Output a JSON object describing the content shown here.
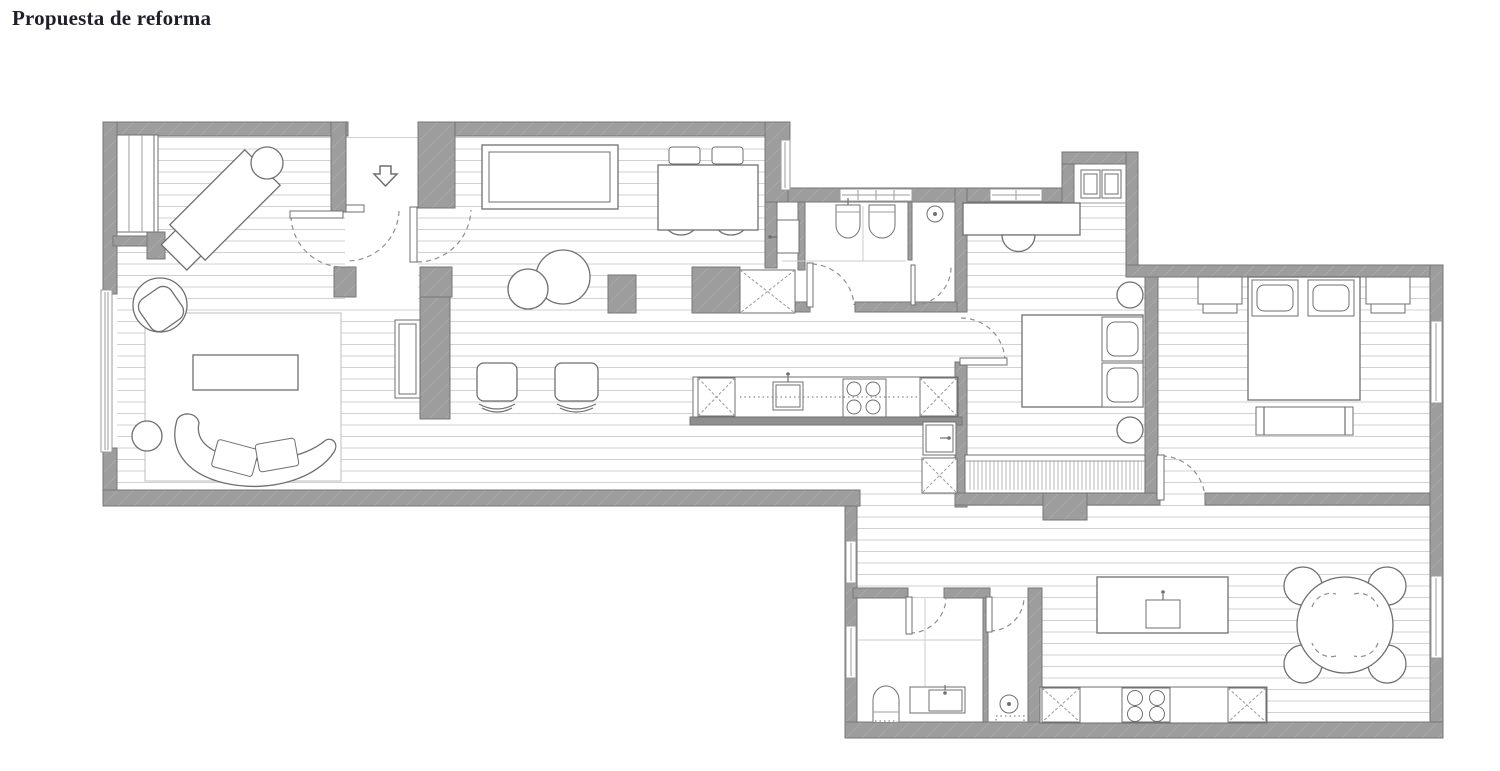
{
  "page": {
    "title": "Propuesta de reforma"
  },
  "colors": {
    "background": "#ffffff",
    "title": "#1f1f2b",
    "wall_fill": "#9d9d9d",
    "wall_hatch": "#a9a9a9",
    "wall_stroke": "#767676",
    "wall_dark": "#8f8f8f",
    "furniture_line": "#6f6f6f",
    "light_line": "#9b9b9b",
    "floor_line": "#d0d0d0",
    "hatch_line": "#b7b7b7",
    "dash_line": "#8f8f8f",
    "rug_line": "#bdbdbd"
  }
}
